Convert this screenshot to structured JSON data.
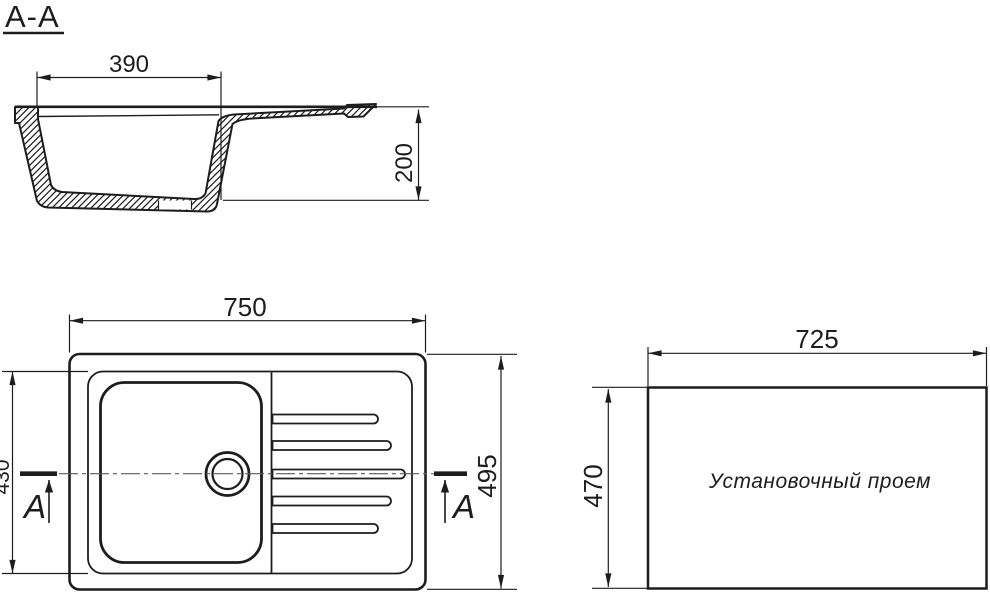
{
  "drawing": {
    "background": "#ffffff",
    "line_color": "#1d1d1d",
    "centerline_color": "#5a5a5a",
    "section_view": {
      "title": "A-A",
      "dim_top_width": "390",
      "dim_depth": "200"
    },
    "top_view": {
      "dim_width": "750",
      "dim_left_height": "430",
      "dim_right_height": "495",
      "cut_label_left": "A",
      "cut_label_right": "A"
    },
    "installation_view": {
      "label": "Установочный проем",
      "dim_width": "725",
      "dim_height": "470"
    }
  }
}
